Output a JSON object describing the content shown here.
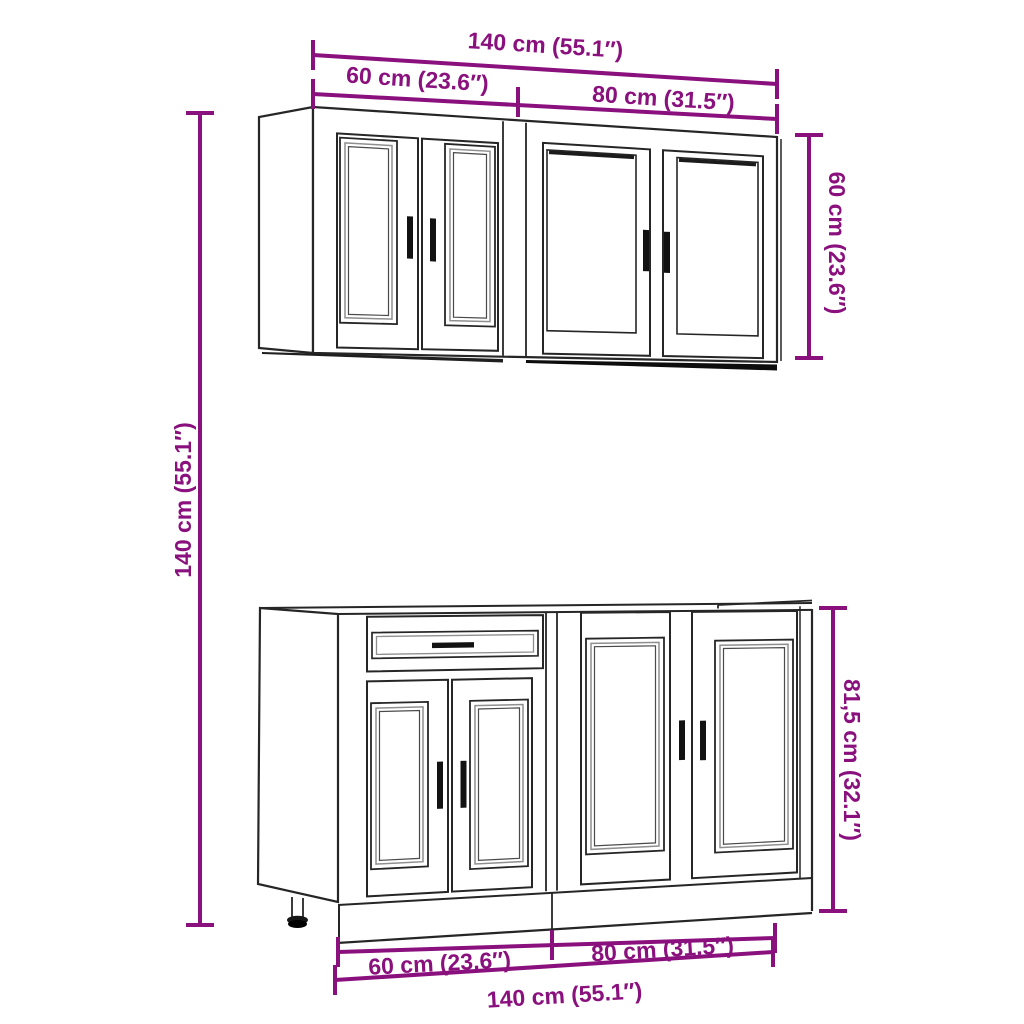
{
  "diagram_title": "Kitchen cabinet set dimension diagram",
  "colors": {
    "accent": "#8A107E",
    "line": "#262626",
    "background": "#ffffff"
  },
  "dimensions": {
    "top_total": "140 cm (55.1″)",
    "top_left_width": "60 cm (23.6″)",
    "top_right_width": "80 cm (31.5″)",
    "wall_cabinet_height": "60 cm (23.6″)",
    "overall_height": "140 cm (55.1″)",
    "base_cabinet_height": "81,5 cm (32.1″)",
    "bottom_left_width": "60 cm (23.6″)",
    "bottom_right_width": "80 cm (31.5″)",
    "bottom_total": "140 cm (55.1″)"
  }
}
